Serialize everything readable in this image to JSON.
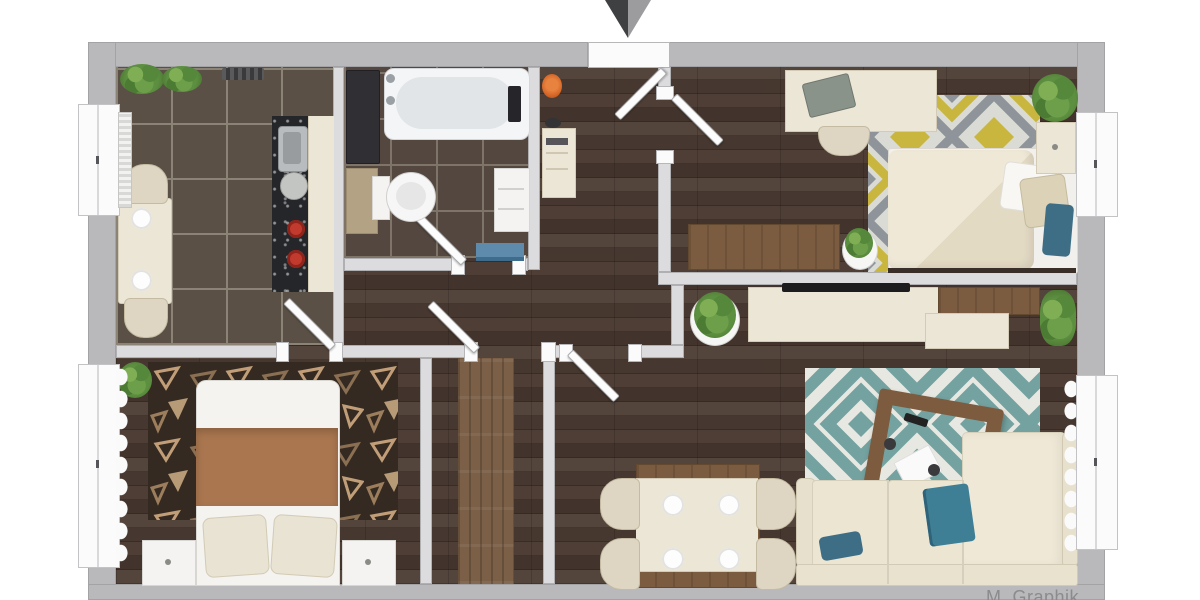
{
  "watermark": {
    "text": "M. Graphik"
  },
  "entrance": {
    "marker": "down-arrow",
    "colors": {
      "left_half": "#3f4042",
      "right_half": "#9c9c9e"
    }
  },
  "palette": {
    "background": "#ffffff",
    "outer_wall": "#b9b9bb",
    "inner_wall": "#dcdcde",
    "wood_floor": "#4a3a32",
    "kitchen_tile": "#5a5046",
    "bathroom_tile": "#544740",
    "hall_runner": "#7b5f47",
    "rug_chevron_teal": "#74a2a0",
    "rug_diamond_yellow": "#c9b63f",
    "rug_diamond_gray": "#8e949a",
    "rug_dark_base": "#342a21",
    "accent_teal_textile": "#3e6e86",
    "blanket_brown": "#a9764f",
    "stove_burner_red": "#c03a2e",
    "bath_mat_blue": "#5e8bab",
    "vase_orange": "#d96a2a"
  },
  "rooms": [
    {
      "name": "kitchen-dining",
      "position": "top-left",
      "floor": "dark-tile",
      "furniture": [
        "dining-table",
        "two-chairs",
        "plates",
        "kitchen-counter",
        "sink",
        "stove-red-burners",
        "windowsill-plants",
        "window",
        "radiator"
      ]
    },
    {
      "name": "bathroom",
      "position": "top-middle",
      "floor": "dark-tile",
      "furniture": [
        "bathtub",
        "faucet",
        "tall-dark-unit",
        "toilet",
        "beige-cabinet",
        "white-shelf-unit",
        "blue-bath-mat",
        "door"
      ]
    },
    {
      "name": "entry-hall",
      "position": "top-center",
      "floor": "wood",
      "furniture": [
        "entrance-door",
        "console-shelf",
        "orange-vase"
      ]
    },
    {
      "name": "bedroom-top-right",
      "position": "top-right",
      "floor": "wood",
      "furniture": [
        "desk",
        "laptop",
        "desk-chair",
        "diamond-pattern-rug",
        "bed",
        "pillows",
        "nightstand",
        "plants",
        "wood-sideboard",
        "window",
        "door"
      ]
    },
    {
      "name": "bedroom-bottom-left",
      "position": "bottom-left",
      "floor": "wood",
      "furniture": [
        "double-bed",
        "brown-blanket",
        "two-pillows",
        "two-nightstands",
        "dark-pattern-rug",
        "plant",
        "window",
        "curtains"
      ]
    },
    {
      "name": "hallway-corridor",
      "position": "bottom-center",
      "floor": "wood",
      "furniture": [
        "wood-runner-rug",
        "doors"
      ]
    },
    {
      "name": "living-dining",
      "position": "bottom-right",
      "floor": "wood",
      "furniture": [
        "tv-console",
        "tv",
        "chevron-rug",
        "wood-coffee-table",
        "corner-sofa",
        "teal-throw",
        "teal-pillow",
        "dining-table-four-chairs",
        "plates",
        "plants",
        "window",
        "curtains"
      ]
    }
  ]
}
